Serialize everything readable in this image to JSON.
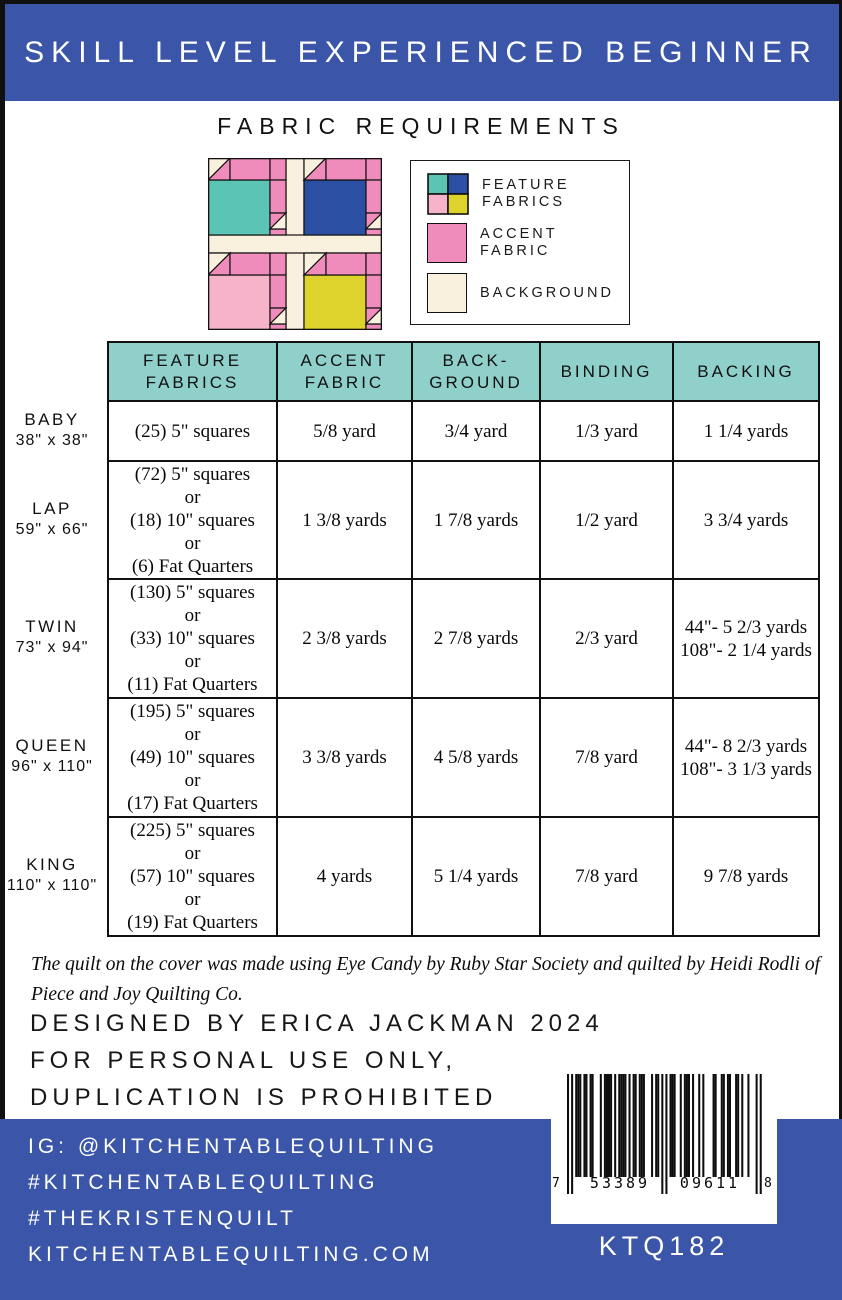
{
  "colors": {
    "band_blue": "#3b56a8",
    "table_header_teal": "#8fd0ca",
    "accent_pink": "#f08cbb",
    "feature_teal": "#5cc4b4",
    "feature_blue": "#2b4fa2",
    "feature_pink": "#f6b3c9",
    "feature_yellow": "#ddd32c",
    "background_cream": "#faf0de"
  },
  "header": {
    "title": "SKILL LEVEL EXPERIENCED BEGINNER"
  },
  "section": {
    "title": "FABRIC REQUIREMENTS"
  },
  "legend": {
    "feature_label": "FEATURE\nFABRICS",
    "accent_label": "ACCENT\nFABRIC",
    "background_label": "BACKGROUND"
  },
  "table": {
    "columns": [
      "FEATURE\nFABRICS",
      "ACCENT\nFABRIC",
      "BACK-\nGROUND",
      "BINDING",
      "BACKING"
    ],
    "rows": [
      {
        "size": "BABY",
        "dims": "38\" x 38\"",
        "feature": "(25) 5\" squares",
        "accent": "5/8 yard",
        "background": "3/4 yard",
        "binding": "1/3 yard",
        "backing": "1 1/4 yards"
      },
      {
        "size": "LAP",
        "dims": "59\" x 66\"",
        "feature": "(72) 5\" squares\nor\n(18) 10\" squares\nor\n(6) Fat Quarters",
        "accent": "1 3/8 yards",
        "background": "1 7/8 yards",
        "binding": "1/2 yard",
        "backing": "3 3/4 yards"
      },
      {
        "size": "TWIN",
        "dims": "73\" x 94\"",
        "feature": "(130) 5\" squares\nor\n(33) 10\" squares\nor\n(11) Fat Quarters",
        "accent": "2 3/8 yards",
        "background": "2 7/8 yards",
        "binding": "2/3 yard",
        "backing": "44\"- 5 2/3 yards\n108\"- 2 1/4 yards"
      },
      {
        "size": "QUEEN",
        "dims": "96\" x 110\"",
        "feature": "(195) 5\" squares\nor\n(49) 10\" squares\nor\n(17) Fat Quarters",
        "accent": "3 3/8 yards",
        "background": "4 5/8 yards",
        "binding": "7/8 yard",
        "backing": "44\"- 8 2/3 yards\n108\"- 3 1/3 yards"
      },
      {
        "size": "KING",
        "dims": "110\" x 110\"",
        "feature": "(225) 5\" squares\nor\n(57) 10\" squares\nor\n(19) Fat Quarters",
        "accent": "4 yards",
        "background": "5 1/4 yards",
        "binding": "7/8 yard",
        "backing": "9 7/8 yards"
      }
    ]
  },
  "note": "The quilt on the cover was made using Eye Candy by Ruby Star Society and quilted by Heidi Rodli of\nPiece and Joy Quilting Co.",
  "credits": {
    "lines": [
      "DESIGNED BY ERICA JACKMAN 2024",
      "FOR PERSONAL USE ONLY,",
      "DUPLICATION IS PROHIBITED"
    ]
  },
  "footer": {
    "lines": [
      "IG: @KITCHENTABLEQUILTING",
      "#KITCHENTABLEQUILTING",
      "#THEKRISTENQUILT",
      "KITCHENTABLEQUILTING.COM"
    ],
    "sku": "KTQ182",
    "barcode": {
      "digits": "753389096118",
      "left_digit": "7",
      "group1": "53389",
      "group2": "09611",
      "right_digit": "8"
    }
  }
}
